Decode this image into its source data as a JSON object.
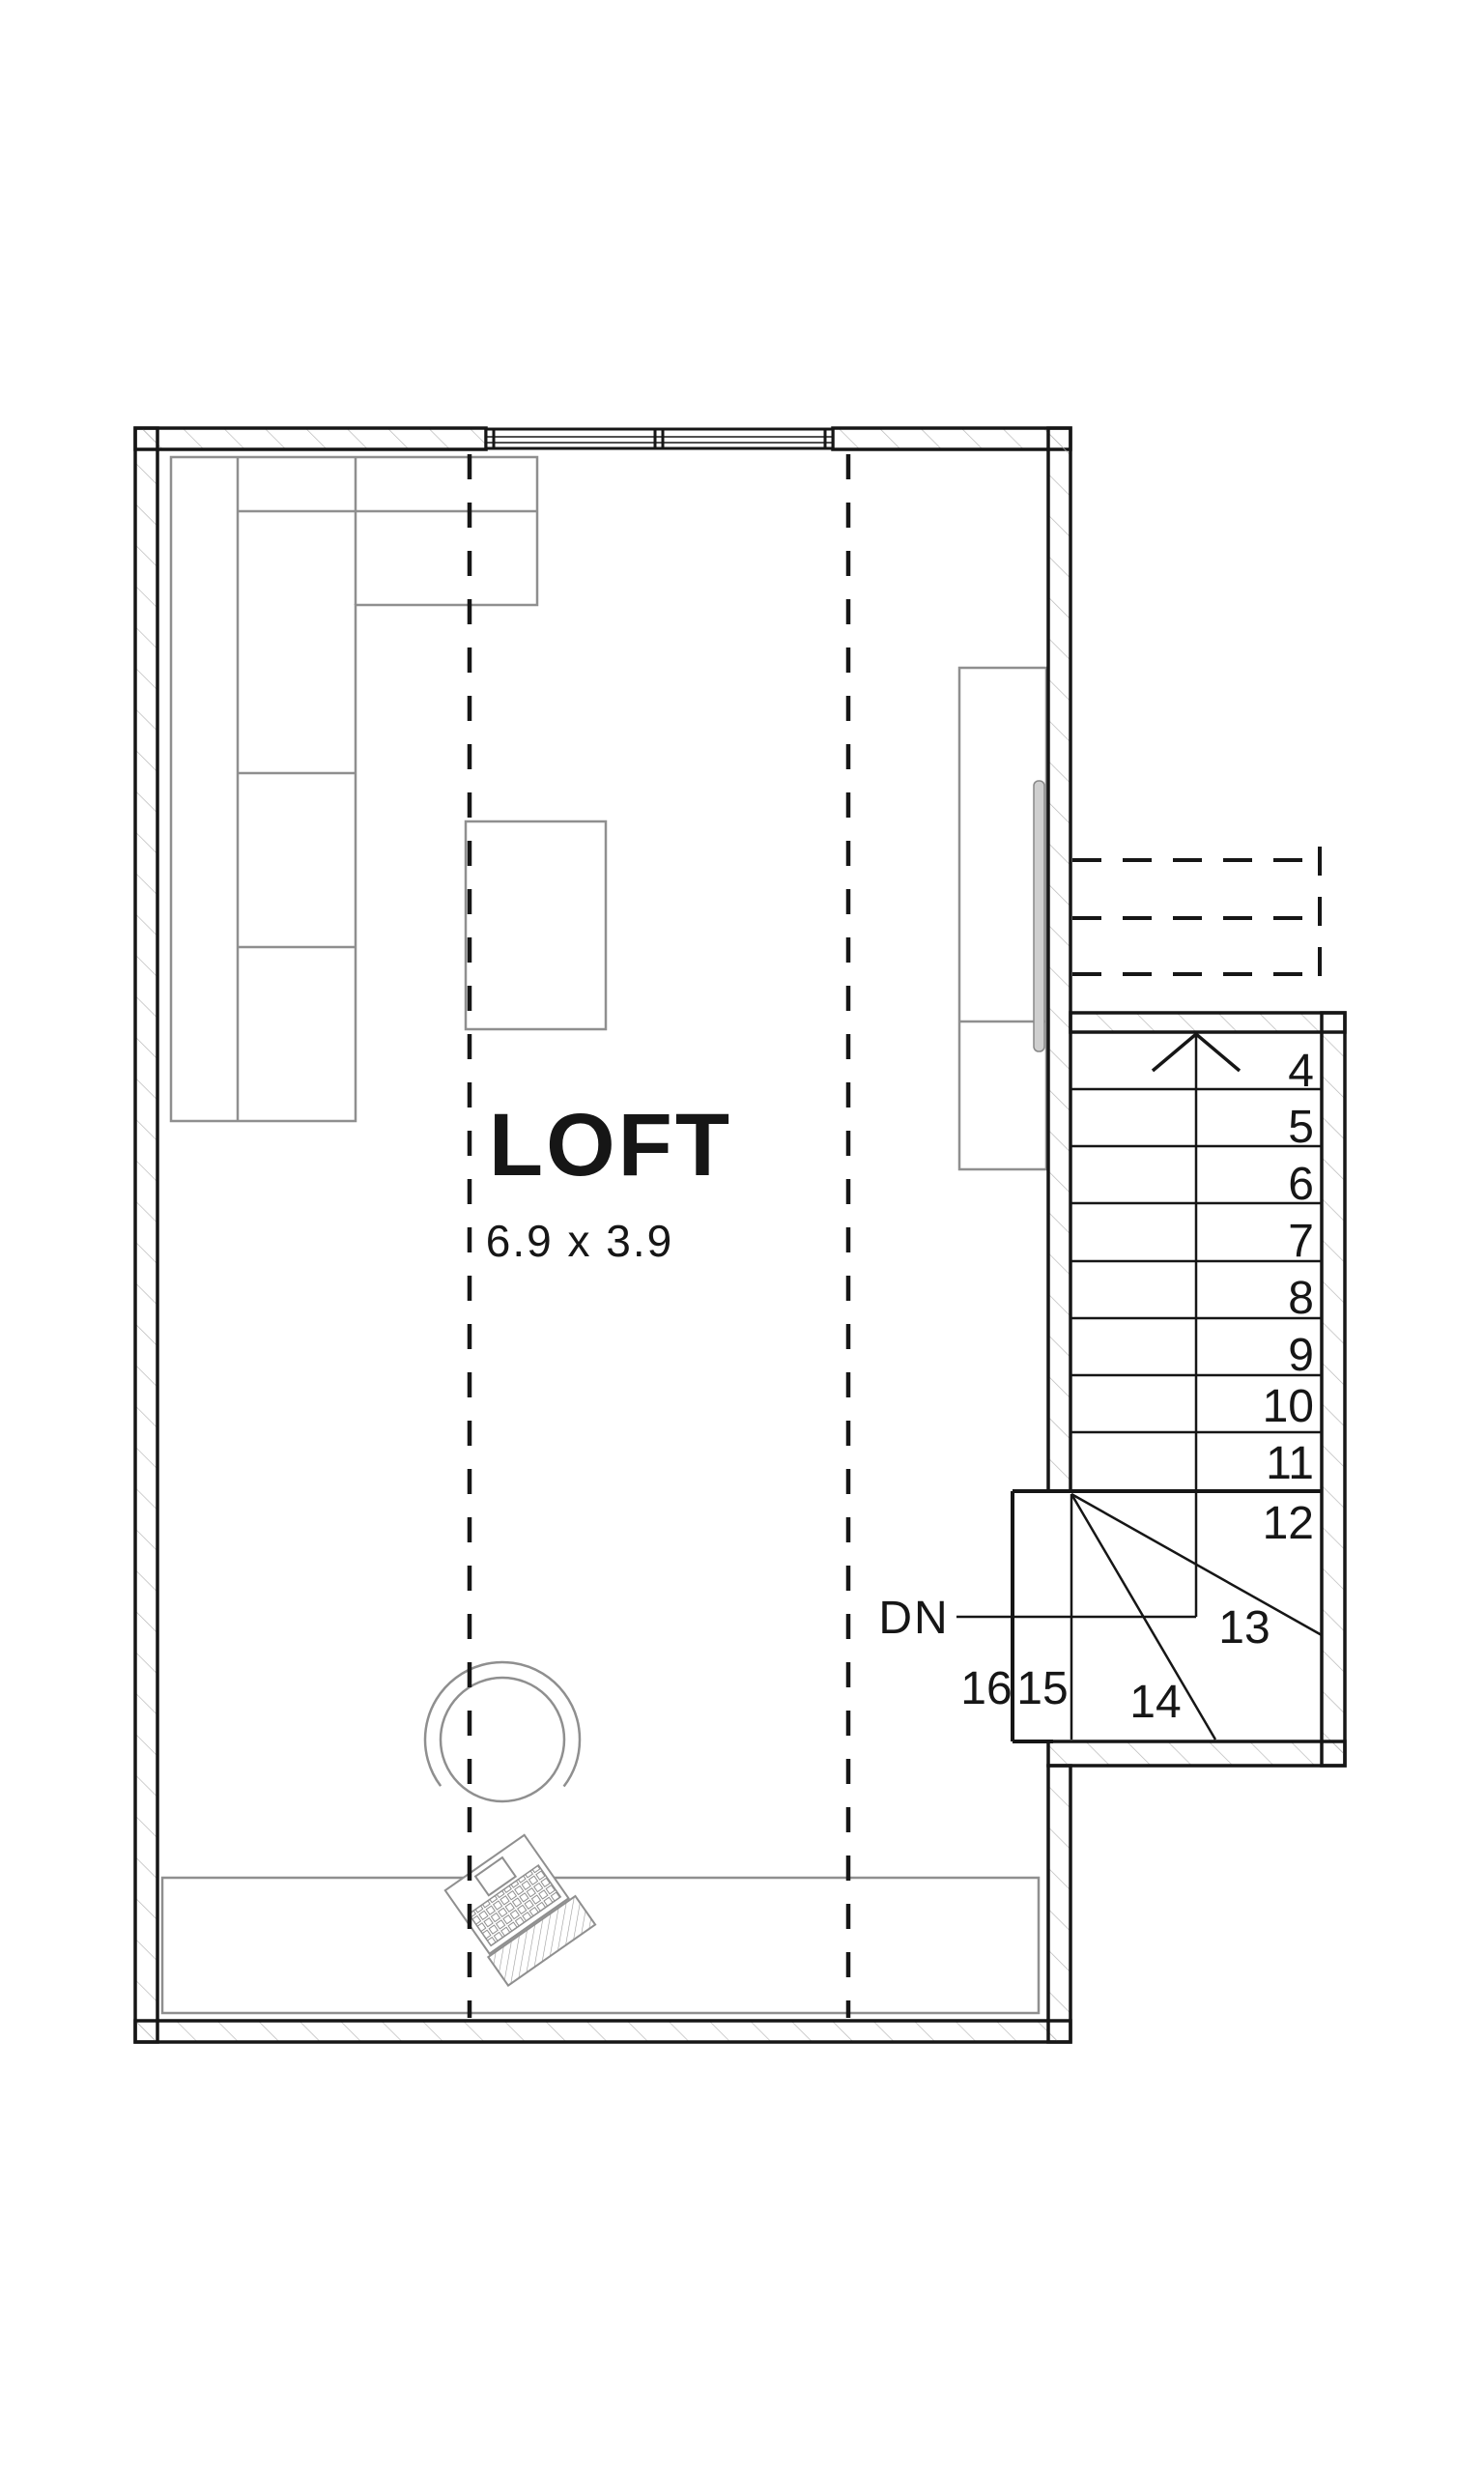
{
  "plan": {
    "room": {
      "name": "LOFT",
      "dimensions": "6.9 x 3.9"
    },
    "stairs": {
      "down_label": "DN",
      "direction": "down",
      "steps": [
        {
          "label": "4"
        },
        {
          "label": "5"
        },
        {
          "label": "6"
        },
        {
          "label": "7"
        },
        {
          "label": "8"
        },
        {
          "label": "9"
        },
        {
          "label": "10"
        },
        {
          "label": "11"
        },
        {
          "label": "12"
        },
        {
          "label": "13"
        },
        {
          "label": "14"
        },
        {
          "label": "15"
        },
        {
          "label": "16"
        }
      ]
    },
    "furniture": {
      "sofa": "sectional-sofa",
      "table": "coffee-table",
      "media_unit": "media-cabinet",
      "tv": "wall-tv",
      "desk": "desk",
      "chair": "desk-chair",
      "laptop": "laptop"
    },
    "colors": {
      "line": "#161616",
      "furniture_line": "#8f8f8f",
      "hatch_line": "#b9b9b9",
      "tv_fill": "#cfcfcf"
    }
  }
}
